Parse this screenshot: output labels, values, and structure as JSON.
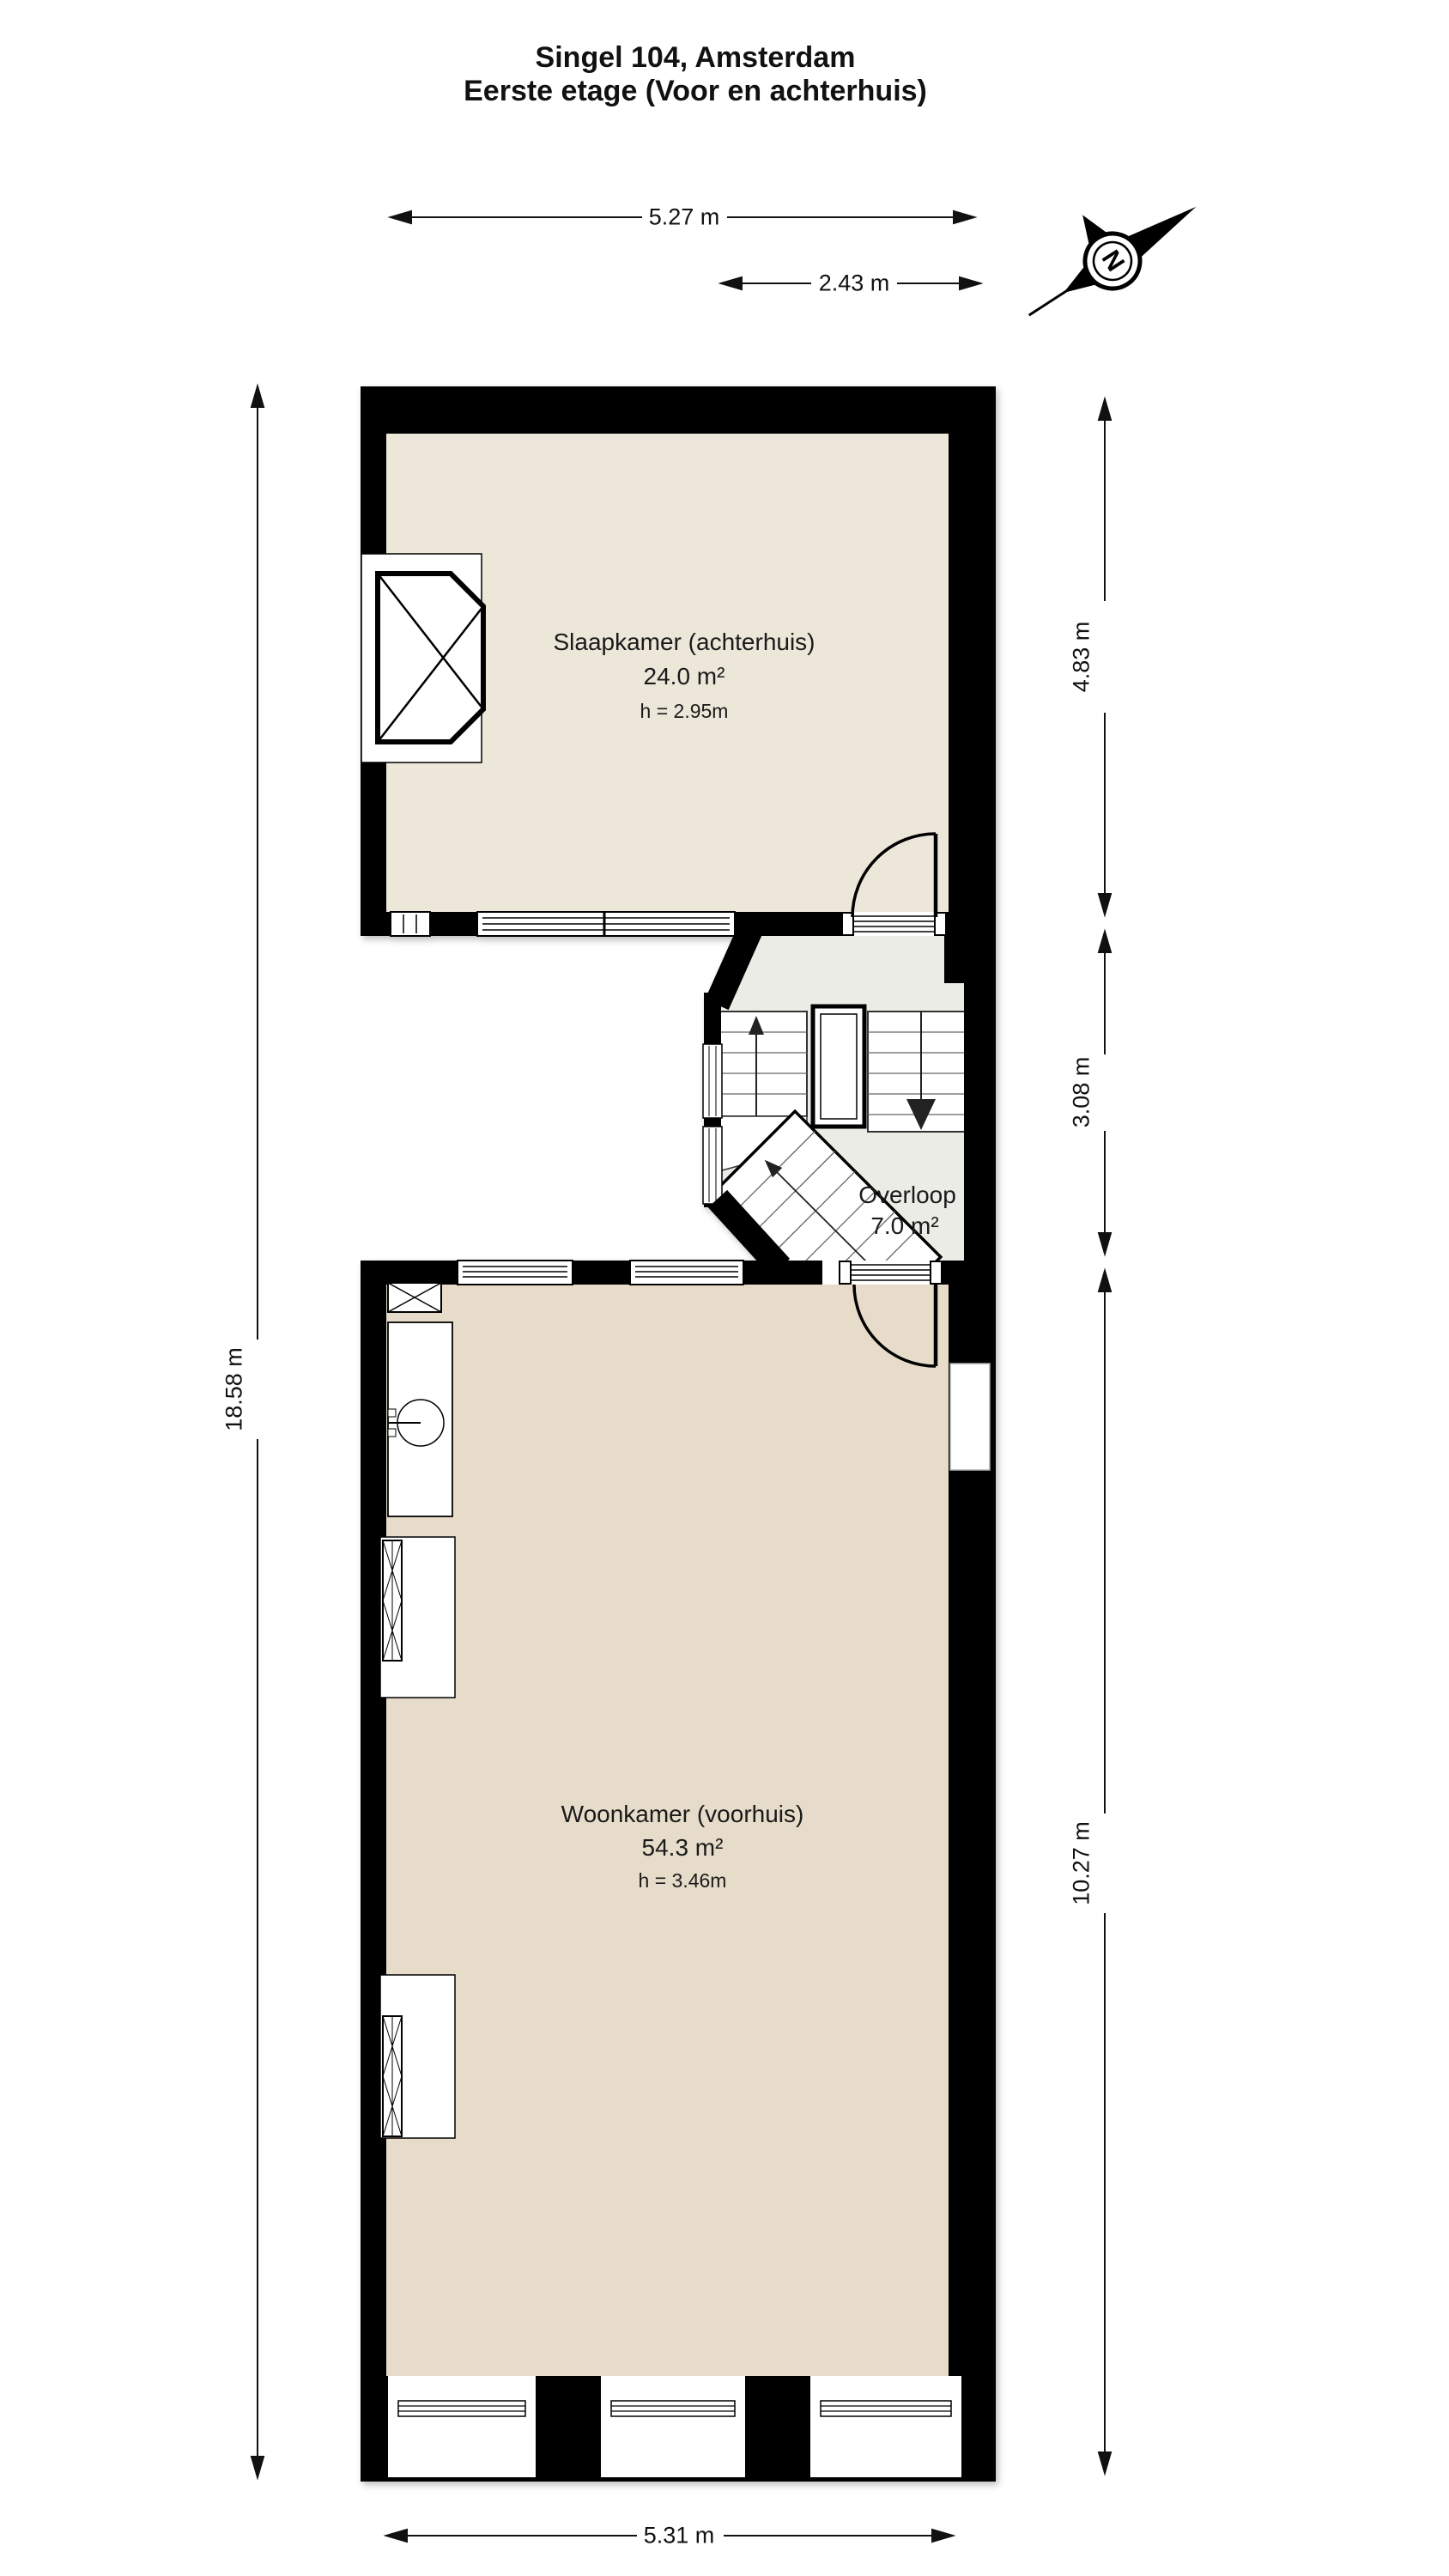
{
  "title": {
    "line1": "Singel 104, Amsterdam",
    "line2": "Eerste etage (Voor en achterhuis)"
  },
  "compass": {
    "north_label": "N"
  },
  "rooms": {
    "slaapkamer": {
      "name": "Slaapkamer (achterhuis)",
      "area": "24.0 m²",
      "ceiling_height": "h = 2.95m"
    },
    "overloop": {
      "name": "Overloop",
      "area": "7.0 m²"
    },
    "woonkamer": {
      "name": "Woonkamer (voorhuis)",
      "area": "54.3 m²",
      "ceiling_height": "h = 3.46m"
    }
  },
  "dimensions": {
    "achterhuis_width": "5.27 m",
    "achterhuis_inner_width": "2.43 m",
    "achterhuis_depth": "4.83 m",
    "stairwell_depth": "3.08 m",
    "voorhuis_depth": "10.27 m",
    "total_depth": "18.58 m",
    "voorhuis_width": "5.31 m"
  },
  "colors": {
    "wall": "#000000",
    "slaapkamer_fill": "#ece7d9",
    "woonkamer_fill": "#e6dcc9",
    "overloop_fill": "#ecece7"
  }
}
